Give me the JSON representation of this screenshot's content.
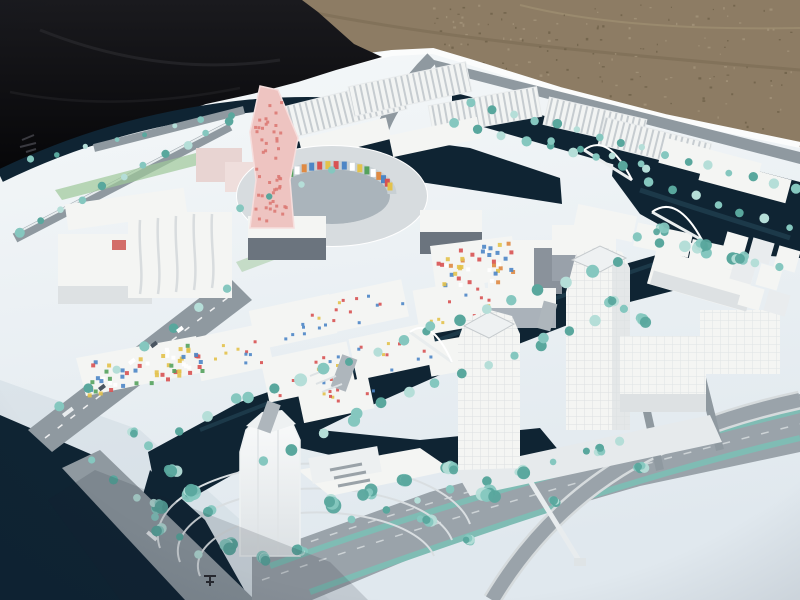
{
  "alt": "Outdoor photograph of a white architectural scale model of a waterfront urban district with canals, teal model trees, a circular courtyard building with colored mosaic facade, a pink speckled tower, white high-rise towers and a wide highway, set on a white board lying on gravel with a black tarp at the top left",
  "palette": {
    "gravel": "#8d7c64",
    "gravel_dark": "#6e6049",
    "gravel_light": "#a4947b",
    "tarp_top": "#1a1a1e",
    "tarp_bottom": "#060608",
    "board_top": "#f5f8f9",
    "board_bottom": "#e0e8ee",
    "board_edge": "#fbfcfc",
    "board_shadow": "#cfdae2",
    "water": "#0f2433",
    "water_light": "#3d6a7e",
    "road": "#8f99a0",
    "road_light": "#9aa3aa",
    "road_dark": "#717c84",
    "building": "#f4f5f3",
    "building_shade": "#dde1e3",
    "glass": "#6b747e",
    "ring_roof": "#d7dcdf",
    "courtyard": "#aab4bb",
    "tree": "#85c7bf",
    "tree_dark": "#59a79d",
    "tree_light": "#b5ded8",
    "pink": "#eec4c1",
    "pink_dot": "#dc7a74",
    "mosaic_red": "#d85252",
    "mosaic_blue": "#4d86c6",
    "mosaic_yellow": "#e3c24b",
    "mosaic_green": "#55a25d",
    "mosaic_orange": "#df8a43",
    "green_strip": "#9ec89a",
    "white": "#ffffff"
  },
  "scene": {
    "gravel_speckles": {
      "n": 150,
      "x_min": 432,
      "x_max": 796,
      "y_min": 4
    },
    "tree_rows": [
      [
        470,
        102,
        795,
        190,
        16,
        4
      ],
      [
        455,
        124,
        645,
        170,
        9,
        4
      ],
      [
        648,
        180,
        788,
        228,
        7,
        4
      ],
      [
        636,
        236,
        780,
        268,
        7,
        5
      ],
      [
        20,
        232,
        228,
        122,
        11,
        4
      ],
      [
        30,
        160,
        230,
        114,
        8,
        3
      ],
      [
        60,
        408,
        228,
        288,
        7,
        4
      ],
      [
        150,
        445,
        236,
        400,
        4,
        5
      ],
      [
        248,
        398,
        428,
        332,
        8,
        5
      ],
      [
        432,
        328,
        618,
        264,
        8,
        5
      ],
      [
        262,
        462,
        352,
        420,
        4,
        5
      ],
      [
        356,
        414,
        540,
        344,
        8,
        5
      ],
      [
        545,
        340,
        622,
        310,
        4,
        5
      ],
      [
        352,
        520,
        618,
        442,
        9,
        4
      ],
      [
        92,
        462,
        200,
        556,
        6,
        4
      ],
      [
        240,
        210,
        330,
        170,
        4,
        3
      ],
      [
        552,
        140,
        640,
        165,
        4,
        3
      ]
    ],
    "tree_clusters": [
      [
        172,
        470,
        9
      ],
      [
        190,
        492,
        11
      ],
      [
        208,
        512,
        9
      ],
      [
        330,
        502,
        12
      ],
      [
        368,
        492,
        10
      ],
      [
        404,
        480,
        9
      ],
      [
        448,
        468,
        10
      ],
      [
        488,
        496,
        11
      ],
      [
        522,
        472,
        9
      ],
      [
        554,
        500,
        8
      ],
      [
        160,
        530,
        8
      ],
      [
        232,
        546,
        10
      ],
      [
        264,
        558,
        9
      ],
      [
        300,
        550,
        8
      ],
      [
        426,
        520,
        9
      ],
      [
        470,
        540,
        8
      ],
      [
        612,
        300,
        9
      ],
      [
        642,
        320,
        8
      ],
      [
        132,
        432,
        7
      ],
      [
        158,
        505,
        10
      ],
      [
        660,
        230,
        8
      ],
      [
        700,
        245,
        9
      ],
      [
        740,
        258,
        8
      ],
      [
        600,
        450,
        7
      ],
      [
        640,
        468,
        7
      ]
    ],
    "dot_fields": [
      {
        "quad": [
          254,
          100,
          284,
          96,
          292,
          222,
          252,
          226
        ],
        "n": 48,
        "size": 3,
        "colors": [
          "pink_dot"
        ]
      },
      {
        "quad": [
          78,
          362,
          194,
          340,
          202,
          372,
          86,
          394
        ],
        "n": 62,
        "size": 4,
        "colors": [
          "mosaic_red",
          "mosaic_blue",
          "mosaic_yellow",
          "mosaic_green",
          "white"
        ]
      },
      {
        "quad": [
          432,
          250,
          510,
          240,
          516,
          278,
          438,
          288
        ],
        "n": 42,
        "size": 4,
        "colors": [
          "mosaic_red",
          "mosaic_blue",
          "mosaic_yellow",
          "mosaic_orange",
          "white"
        ]
      },
      {
        "quad": [
          198,
          348,
          268,
          334,
          272,
          364,
          202,
          378
        ],
        "n": 10,
        "size": 3,
        "colors": [
          "mosaic_red",
          "mosaic_blue",
          "mosaic_yellow"
        ]
      },
      {
        "quad": [
          256,
          316,
          334,
          302,
          338,
          330,
          260,
          344
        ],
        "n": 10,
        "size": 3,
        "colors": [
          "mosaic_red",
          "mosaic_blue",
          "mosaic_yellow"
        ]
      },
      {
        "quad": [
          322,
          300,
          406,
          288,
          410,
          314,
          326,
          326
        ],
        "n": 10,
        "size": 3,
        "colors": [
          "mosaic_red",
          "mosaic_blue",
          "mosaic_yellow"
        ]
      },
      {
        "quad": [
          266,
          366,
          352,
          350,
          356,
          380,
          270,
          396
        ],
        "n": 12,
        "size": 3,
        "colors": [
          "mosaic_red",
          "mosaic_blue",
          "mosaic_yellow"
        ]
      },
      {
        "quad": [
          356,
          344,
          436,
          330,
          440,
          360,
          360,
          374
        ],
        "n": 10,
        "size": 3,
        "colors": [
          "mosaic_red",
          "mosaic_blue",
          "mosaic_yellow"
        ]
      },
      {
        "quad": [
          418,
          296,
          486,
          286,
          490,
          320,
          422,
          330
        ],
        "n": 10,
        "size": 3,
        "colors": [
          "mosaic_red",
          "mosaic_blue",
          "mosaic_yellow"
        ]
      },
      {
        "quad": [
          306,
          392,
          372,
          378,
          374,
          402,
          308,
          416
        ],
        "n": 8,
        "size": 3,
        "colors": [
          "mosaic_red",
          "mosaic_blue",
          "mosaic_yellow"
        ]
      }
    ],
    "ring_mosaic": {
      "cx": 332,
      "cy": 194,
      "rx": 60,
      "ry": 29,
      "start": 195,
      "end": 345,
      "n": 20,
      "w": 5,
      "h": 8,
      "colors": [
        "mosaic_red",
        "mosaic_blue",
        "white",
        "mosaic_yellow",
        "mosaic_green",
        "white",
        "mosaic_orange",
        "mosaic_blue",
        "mosaic_red",
        "mosaic_yellow"
      ]
    },
    "cars": [
      [
        150,
        345
      ],
      [
        128,
        362
      ],
      [
        98,
        388
      ],
      [
        176,
        330
      ]
    ]
  }
}
